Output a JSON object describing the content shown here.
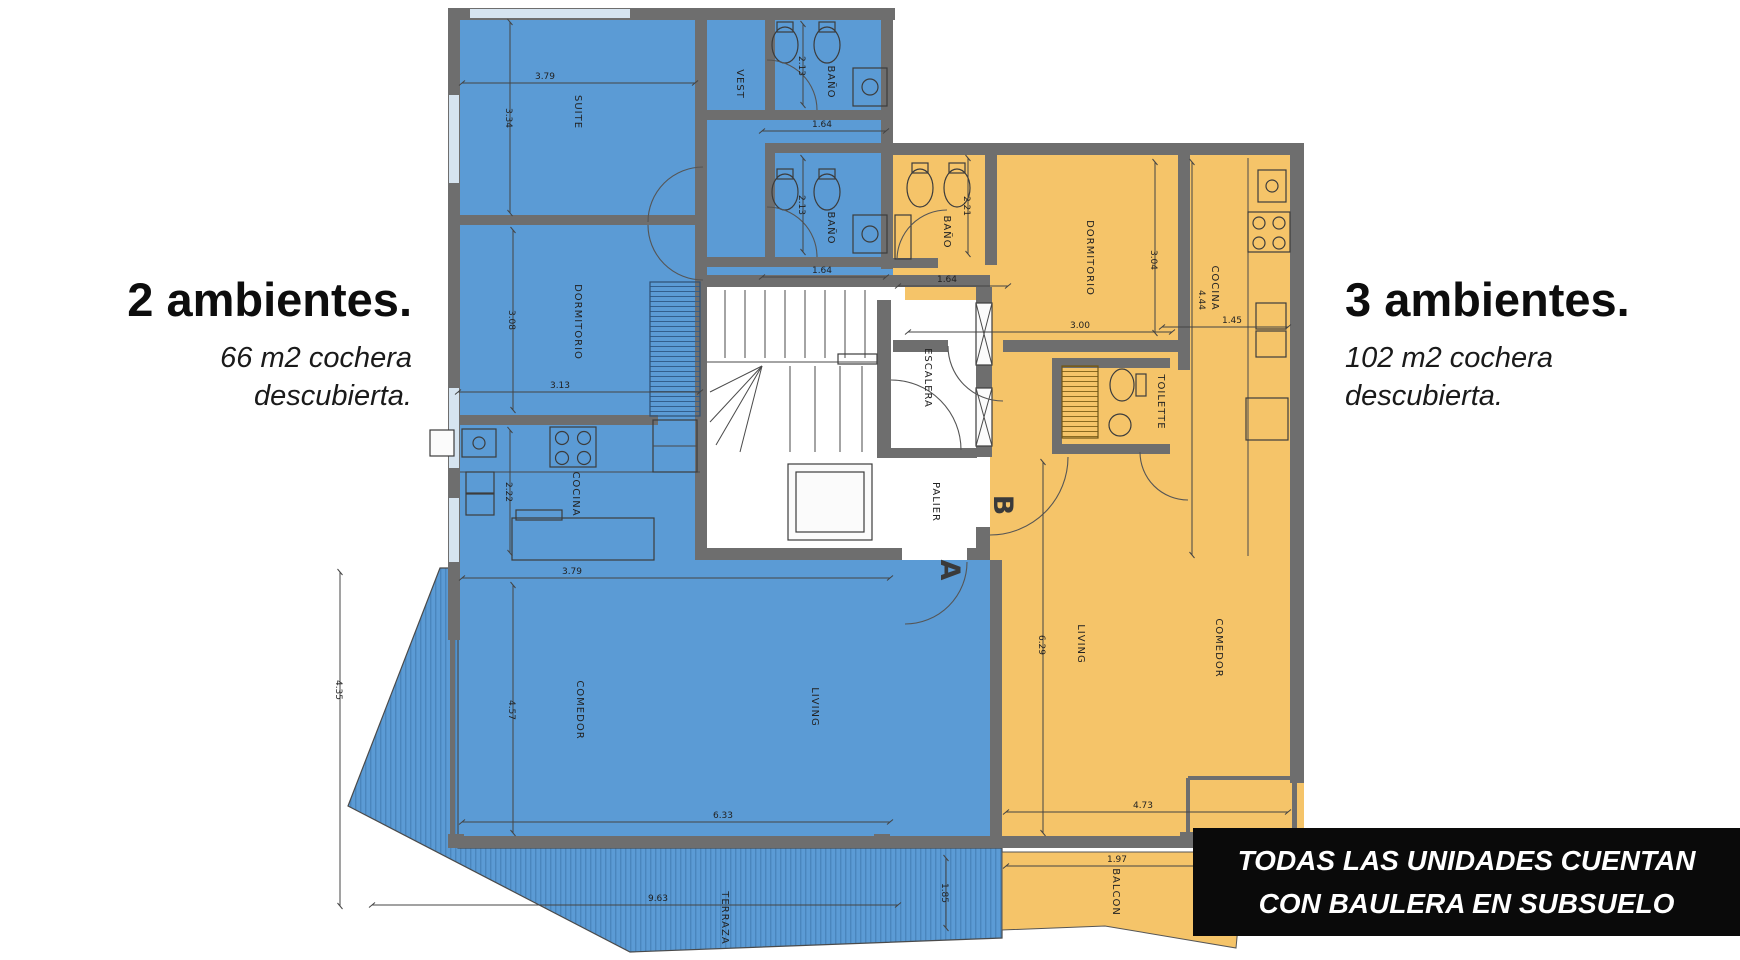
{
  "left_panel": {
    "title": "2 ambientes.",
    "subtitle_line1": "66 m2 cochera",
    "subtitle_line2": "descubierta."
  },
  "right_panel": {
    "title": "3 ambientes.",
    "subtitle_line1": "102 m2 cochera",
    "subtitle_line2": "descubierta."
  },
  "banner": {
    "line1": "TODAS LAS UNIDADES CUENTAN",
    "line2": "CON BAULERA EN SUBSUELO",
    "bg": "#0a0a0a",
    "text_color": "#ffffff"
  },
  "colors": {
    "unit2_fill": "#5b9bd5",
    "unit3_fill": "#f5c469",
    "wall": "#6e6e6e",
    "dim_text": "#222222",
    "terrace_stripe": "#4a86bd"
  },
  "plan": {
    "unit2": {
      "name": "2 ambientes",
      "rooms": {
        "suite": "SUITE",
        "vest": "VEST",
        "bano1": "BAÑO",
        "bano2": "BAÑO",
        "dormitorio": "DORMITORIO",
        "cocina": "COCINA",
        "comedor": "COMEDOR",
        "living": "LIVING",
        "terraza": "TERRAZA"
      },
      "dims": {
        "suite_w": "3.79",
        "suite_h": "3.34",
        "bano1_h": "2.13",
        "bano1_w": "1.64",
        "bano2_h": "2.13",
        "bano2_w": "1.64",
        "dorm_h": "3.08",
        "dorm_w": "3.13",
        "cocina_h": "2.22",
        "cocina_w": "3.79",
        "comedor_h": "4.57",
        "living_w": "6.33",
        "terraza_w": "9.63",
        "terraza_h": "4.35",
        "terraza_e": "1.85"
      }
    },
    "unit3": {
      "name": "3 ambientes",
      "rooms": {
        "bano": "BAÑO",
        "dormitorio": "DORMITORIO",
        "cocina": "COCINA",
        "toilette": "TOILETTE",
        "living": "LIVING",
        "comedor": "COMEDOR",
        "balcon": "BALCON"
      },
      "dims": {
        "bano_h": "2.21",
        "bano_w": "1.64",
        "dorm_h": "3.04",
        "dorm_w": "3.00",
        "cocina_h": "4.44",
        "cocina_w": "1.45",
        "living_h": "6.29",
        "living_w": "4.73",
        "balcon_w": "1.97"
      }
    },
    "core": {
      "escalera": "ESCALERA",
      "palier": "PALIER",
      "unit_a_letter": "A",
      "unit_b_letter": "B"
    }
  }
}
